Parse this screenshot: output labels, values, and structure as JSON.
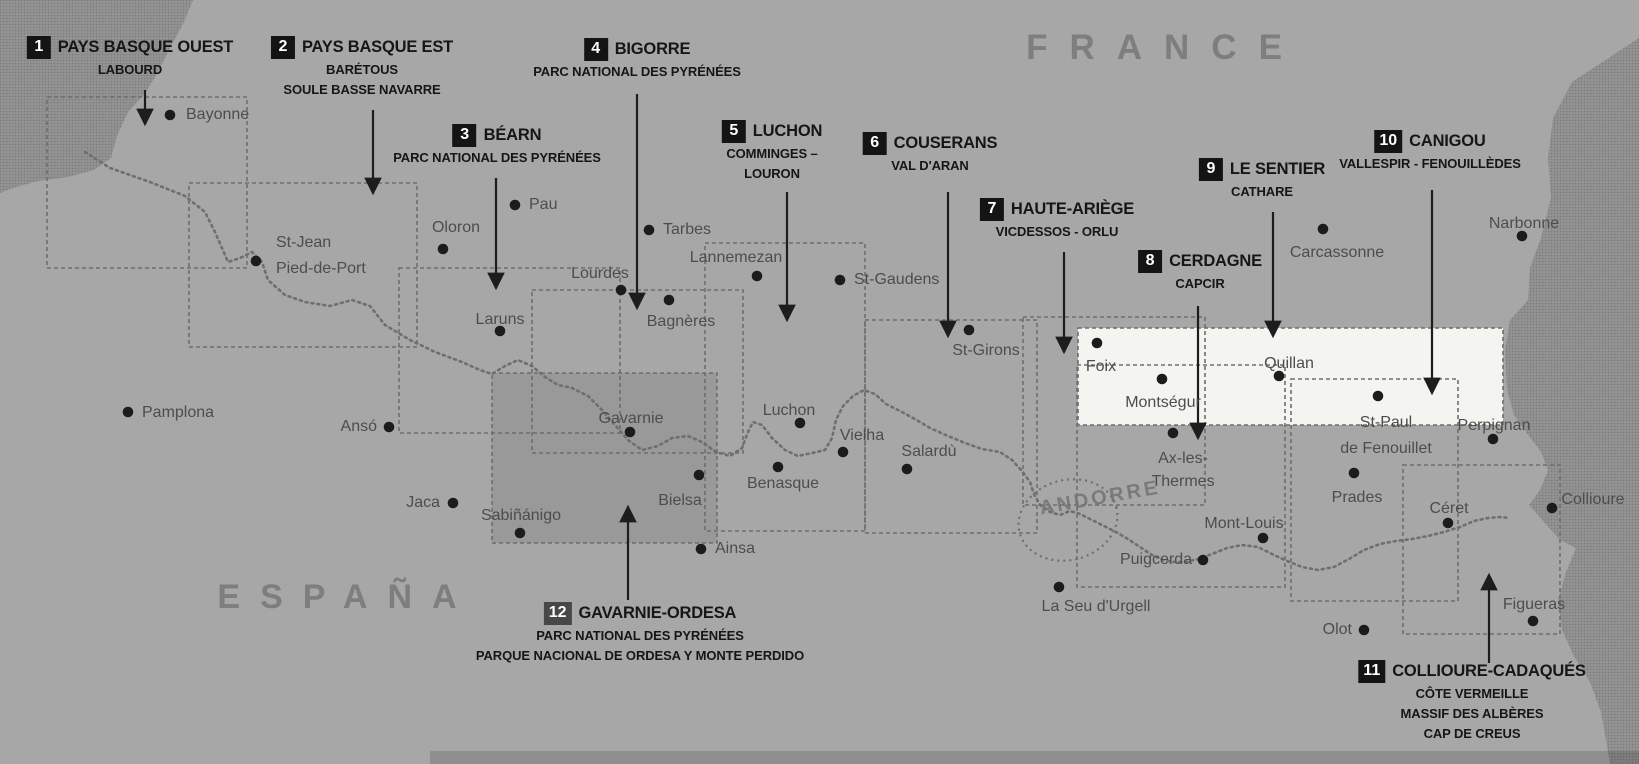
{
  "map": {
    "country_labels": {
      "france": "FRANCE",
      "espana": "ESPAÑA",
      "andorre": "ANDORRE"
    },
    "colors": {
      "land": "#a7a7a7",
      "sea_base": "#8f8f8f",
      "sea_dark": "#7b7b7b",
      "sea_light": "#9a9a9a",
      "highlight_band": "#f4f4f1",
      "shaded_sheet": "rgba(30,30,30,0.10)",
      "sheet_outline": "#6e6e6e",
      "trail": "#6f6f6f",
      "arrow": "#1d1d1d",
      "city_dot": "#1c1c1c",
      "badge_bg": "#141414",
      "badge_alt_bg": "#474747",
      "badge_text": "#ffffff",
      "region_text": "#161616",
      "city_text": "#4d4d4d",
      "country_text": "#7e7e7e",
      "bottom_shadow": "rgba(0,0,0,0.14)"
    },
    "regions": [
      {
        "num": "1",
        "title": "PAYS BASQUE OUEST",
        "subs": [
          "LABOURD"
        ],
        "cx": 130,
        "top": 36,
        "arrow": [
          145,
          90,
          145,
          124
        ],
        "rect": [
          47,
          97,
          200,
          171
        ]
      },
      {
        "num": "2",
        "title": "PAYS BASQUE EST",
        "subs": [
          "BARÉTOUS",
          "SOULE BASSE NAVARRE"
        ],
        "cx": 362,
        "top": 36,
        "arrow": [
          373,
          110,
          373,
          193
        ],
        "rect": [
          189,
          183,
          228,
          164
        ]
      },
      {
        "num": "3",
        "title": "BÉARN",
        "subs": [
          "PARC NATIONAL DES PYRÉNÉES"
        ],
        "cx": 497,
        "top": 124,
        "arrow": [
          496,
          178,
          496,
          288
        ],
        "rect": [
          399,
          268,
          221,
          165
        ]
      },
      {
        "num": "4",
        "title": "BIGORRE",
        "subs": [
          "PARC NATIONAL DES PYRÉNÉES"
        ],
        "cx": 637,
        "top": 38,
        "arrow": [
          637,
          94,
          637,
          308
        ],
        "rect": [
          532,
          290,
          211,
          163
        ]
      },
      {
        "num": "5",
        "title": "LUCHON",
        "subs": [
          "COMMINGES –",
          "LOURON"
        ],
        "cx": 772,
        "top": 120,
        "arrow": [
          787,
          192,
          787,
          320
        ],
        "rect": [
          705,
          243,
          160,
          288
        ]
      },
      {
        "num": "6",
        "title": "COUSERANS",
        "subs": [
          "VAL D'ARAN"
        ],
        "cx": 930,
        "top": 132,
        "arrow": [
          948,
          192,
          948,
          336
        ],
        "rect": [
          865,
          320,
          172,
          213
        ]
      },
      {
        "num": "7",
        "title": "HAUTE-ARIÈGE",
        "subs": [
          "VICDESSOS - ORLU"
        ],
        "cx": 1057,
        "top": 198,
        "arrow": [
          1064,
          252,
          1064,
          352
        ],
        "rect": [
          1023,
          317,
          182,
          188
        ]
      },
      {
        "num": "8",
        "title": "CERDAGNE",
        "subs": [
          "CAPCIR"
        ],
        "cx": 1200,
        "top": 250,
        "arrow": [
          1198,
          306,
          1198,
          438
        ],
        "rect": [
          1077,
          365,
          208,
          222
        ]
      },
      {
        "num": "9",
        "title": "LE SENTIER",
        "subs": [
          "CATHARE"
        ],
        "cx": 1262,
        "top": 158,
        "arrow": [
          1273,
          212,
          1273,
          336
        ],
        "rect": [
          1078,
          328,
          425,
          97
        ],
        "highlight": true
      },
      {
        "num": "10",
        "title": "CANIGOU",
        "subs": [
          "VALLESPIR - FENOUILLÈDES"
        ],
        "cx": 1430,
        "top": 130,
        "arrow": [
          1432,
          190,
          1432,
          393
        ],
        "rect": [
          1291,
          379,
          167,
          222
        ]
      },
      {
        "num": "11",
        "title": "COLLIOURE-CADAQUÉS",
        "subs": [
          "CÔTE VERMEILLE",
          "MASSIF DES ALBÈRES",
          "CAP DE CREUS"
        ],
        "cx": 1472,
        "top": 660,
        "arrow": [
          1489,
          663,
          1489,
          575
        ],
        "rect": [
          1403,
          465,
          157,
          169
        ]
      },
      {
        "num": "12",
        "title": "GAVARNIE-ORDESA",
        "subs": [
          "PARC NATIONAL DES PYRÉNÉES",
          "PARQUE NACIONAL DE ORDESA Y MONTE PERDIDO"
        ],
        "cx": 640,
        "top": 602,
        "arrow": [
          628,
          600,
          628,
          507
        ],
        "rect": [
          492,
          373,
          225,
          170
        ],
        "shaded": true,
        "badge_alt": true
      }
    ],
    "cities": [
      {
        "name": "Bayonne",
        "dot": [
          170,
          115
        ],
        "lines": [
          "Bayonne"
        ],
        "align": "left",
        "pos": [
          186,
          104
        ]
      },
      {
        "name": "St-Jean Pied-de-Port",
        "dot": [
          256,
          261
        ],
        "lines": [
          "St-Jean",
          "Pied-de-Port"
        ],
        "align": "left",
        "pos": [
          276,
          230
        ],
        "lh": 26
      },
      {
        "name": "Pamplona",
        "dot": [
          128,
          412
        ],
        "lines": [
          "Pamplona"
        ],
        "align": "left",
        "pos": [
          142,
          402
        ]
      },
      {
        "name": "Oloron",
        "dot": [
          443,
          249
        ],
        "lines": [
          "Oloron"
        ],
        "align": "center",
        "pos": [
          456,
          217
        ]
      },
      {
        "name": "Pau",
        "dot": [
          515,
          205
        ],
        "lines": [
          "Pau"
        ],
        "align": "left",
        "pos": [
          529,
          194
        ]
      },
      {
        "name": "Laruns",
        "dot": [
          500,
          331
        ],
        "lines": [
          "Laruns"
        ],
        "align": "center",
        "pos": [
          500,
          309
        ]
      },
      {
        "name": "Lourdes",
        "dot": [
          621,
          290
        ],
        "lines": [
          "Lourdes"
        ],
        "align": "center",
        "pos": [
          600,
          263
        ]
      },
      {
        "name": "Tarbes",
        "dot": [
          649,
          230
        ],
        "lines": [
          "Tarbes"
        ],
        "align": "left",
        "pos": [
          663,
          219
        ]
      },
      {
        "name": "Lannemezan",
        "dot": [
          757,
          276
        ],
        "lines": [
          "Lannemezan"
        ],
        "align": "center",
        "pos": [
          736,
          247
        ]
      },
      {
        "name": "Bagnères",
        "dot": [
          669,
          300
        ],
        "lines": [
          "Bagnères"
        ],
        "align": "center",
        "pos": [
          681,
          311
        ]
      },
      {
        "name": "St-Gaudens",
        "dot": [
          840,
          280
        ],
        "lines": [
          "St-Gaudens"
        ],
        "align": "left",
        "pos": [
          854,
          269
        ]
      },
      {
        "name": "St-Girons",
        "dot": [
          969,
          330
        ],
        "lines": [
          "St-Girons"
        ],
        "align": "center",
        "pos": [
          986,
          340
        ]
      },
      {
        "name": "Luchon",
        "dot": [
          800,
          423
        ],
        "lines": [
          "Luchon"
        ],
        "align": "center",
        "pos": [
          789,
          400
        ]
      },
      {
        "name": "Vielha",
        "dot": [
          843,
          452
        ],
        "lines": [
          "Vielha"
        ],
        "align": "center",
        "pos": [
          862,
          425
        ]
      },
      {
        "name": "Salardù",
        "dot": [
          907,
          469
        ],
        "lines": [
          "Salardù"
        ],
        "align": "center",
        "pos": [
          929,
          441
        ]
      },
      {
        "name": "Benasque",
        "dot": [
          778,
          467
        ],
        "lines": [
          "Benasque"
        ],
        "align": "center",
        "pos": [
          783,
          473
        ]
      },
      {
        "name": "Bielsa",
        "dot": [
          699,
          475
        ],
        "lines": [
          "Bielsa"
        ],
        "align": "center",
        "pos": [
          680,
          490
        ]
      },
      {
        "name": "Gavarnie",
        "dot": [
          630,
          432
        ],
        "lines": [
          "Gavarnie"
        ],
        "align": "center",
        "pos": [
          631,
          408
        ]
      },
      {
        "name": "Ainsa",
        "dot": [
          701,
          549
        ],
        "lines": [
          "Ainsa"
        ],
        "align": "left",
        "pos": [
          715,
          538
        ]
      },
      {
        "name": "Ansó",
        "dot": [
          389,
          427
        ],
        "lines": [
          "Ansó"
        ],
        "align": "right",
        "pos": [
          377,
          416
        ]
      },
      {
        "name": "Jaca",
        "dot": [
          453,
          503
        ],
        "lines": [
          "Jaca"
        ],
        "align": "right",
        "pos": [
          440,
          492
        ]
      },
      {
        "name": "Sabiñánigo",
        "dot": [
          520,
          533
        ],
        "lines": [
          "Sabiñánigo"
        ],
        "align": "center",
        "pos": [
          521,
          505
        ]
      },
      {
        "name": "Foix",
        "dot": [
          1097,
          343
        ],
        "lines": [
          "Foix"
        ],
        "align": "center",
        "pos": [
          1101,
          356
        ]
      },
      {
        "name": "Montségur",
        "dot": [
          1162,
          379
        ],
        "lines": [
          "Montségur"
        ],
        "align": "center",
        "pos": [
          1163,
          392
        ]
      },
      {
        "name": "Ax-les-Thermes",
        "dot": [
          1173,
          433
        ],
        "lines": [
          "Ax-les-",
          "Thermes"
        ],
        "align": "center",
        "pos": [
          1183,
          447
        ],
        "lh": 23
      },
      {
        "name": "Quillan",
        "dot": [
          1279,
          376
        ],
        "lines": [
          "Quillan"
        ],
        "align": "center",
        "pos": [
          1289,
          353
        ]
      },
      {
        "name": "Carcassonne",
        "dot": [
          1323,
          229
        ],
        "lines": [
          "Carcassonne"
        ],
        "align": "center",
        "pos": [
          1337,
          242
        ]
      },
      {
        "name": "Narbonne",
        "dot": [
          1522,
          236
        ],
        "lines": [
          "Narbonne"
        ],
        "align": "center",
        "pos": [
          1524,
          213
        ]
      },
      {
        "name": "St-Paul de Fenouillet",
        "dot": [
          1378,
          396
        ],
        "lines": [
          "St-Paul",
          "de Fenouillet"
        ],
        "align": "center",
        "pos": [
          1386,
          410
        ],
        "lh": 26
      },
      {
        "name": "Perpignan",
        "dot": [
          1493,
          439
        ],
        "lines": [
          "Perpignan"
        ],
        "align": "center",
        "pos": [
          1494,
          415
        ]
      },
      {
        "name": "Prades",
        "dot": [
          1354,
          473
        ],
        "lines": [
          "Prades"
        ],
        "align": "center",
        "pos": [
          1357,
          487
        ]
      },
      {
        "name": "Céret",
        "dot": [
          1448,
          523
        ],
        "lines": [
          "Céret"
        ],
        "align": "center",
        "pos": [
          1449,
          498
        ]
      },
      {
        "name": "Collioure",
        "dot": [
          1552,
          508
        ],
        "lines": [
          "Collioure"
        ],
        "align": "center",
        "pos": [
          1593,
          489
        ]
      },
      {
        "name": "Mont-Louis",
        "dot": [
          1263,
          538
        ],
        "lines": [
          "Mont-Louis"
        ],
        "align": "center",
        "pos": [
          1244,
          513
        ]
      },
      {
        "name": "Puigcerda",
        "dot": [
          1203,
          560
        ],
        "lines": [
          "Puigcerda"
        ],
        "align": "right",
        "pos": [
          1192,
          549
        ]
      },
      {
        "name": "La Seu d'Urgell",
        "dot": [
          1059,
          587
        ],
        "lines": [
          "La Seu d'Urgell"
        ],
        "align": "center",
        "pos": [
          1096,
          596
        ]
      },
      {
        "name": "Olot",
        "dot": [
          1364,
          630
        ],
        "lines": [
          "Olot"
        ],
        "align": "right",
        "pos": [
          1352,
          619
        ]
      },
      {
        "name": "Figueras",
        "dot": [
          1533,
          621
        ],
        "lines": [
          "Figueras"
        ],
        "align": "center",
        "pos": [
          1534,
          594
        ]
      }
    ],
    "geometry": {
      "width": 1639,
      "height": 764,
      "france_pos": [
        1165,
        28
      ],
      "espana_pos": [
        347,
        578
      ],
      "andorre_pos": [
        1100,
        487
      ],
      "sea_polygons": [
        "0,0 193,0 184,22 170,48 158,72 146,92 128,112 117,136 111,158 94,170 68,177 38,181 16,187 0,193",
        "1639,38 1572,82 1553,118 1548,158 1551,198 1541,238 1530,268 1528,300 1510,320 1505,350 1507,390 1514,415 1526,432 1541,452 1548,470 1540,490 1529,505 1544,522 1560,540 1576,548 1566,572 1558,600 1562,630 1574,656 1590,682 1601,712 1606,740 1610,764 1639,764"
      ],
      "bottom_shadow_rect": [
        430,
        751,
        1209,
        13
      ],
      "andorra_loop": {
        "cx": 1068,
        "cy": 520,
        "rx": 50,
        "ry": 40,
        "angle": -15
      },
      "trail": "85,152 110,168 150,182 185,196 205,212 215,232 228,262 240,258 252,252 262,262 268,280 285,295 305,302 330,306 352,300 370,306 385,325 410,340 435,352 462,362 480,370 492,374 505,366 518,360 532,366 545,377 558,385 572,388 588,396 602,410 615,425 628,440 642,450 658,446 672,438 688,436 702,442 716,452 730,456 742,448 748,432 753,422 762,425 772,438 785,450 798,456 812,453 825,450 832,438 836,420 843,406 853,396 864,390 875,394 886,404 900,411 915,419 930,428 948,436 965,443 982,449 1000,452 1012,460 1022,471 1030,482 1034,494 1040,505 1050,512 1060,515 1070,511 1080,514 1092,520 1104,526 1116,532 1128,539 1140,547 1152,555 1163,560 1174,562 1186,562 1198,559 1212,554 1227,548 1242,545 1258,547 1272,554 1287,561 1302,567 1318,570 1334,567 1349,559 1364,550 1380,544 1396,541 1412,539 1428,536 1444,532 1460,527 1474,521 1488,518 1500,517 1509,518"
    }
  }
}
